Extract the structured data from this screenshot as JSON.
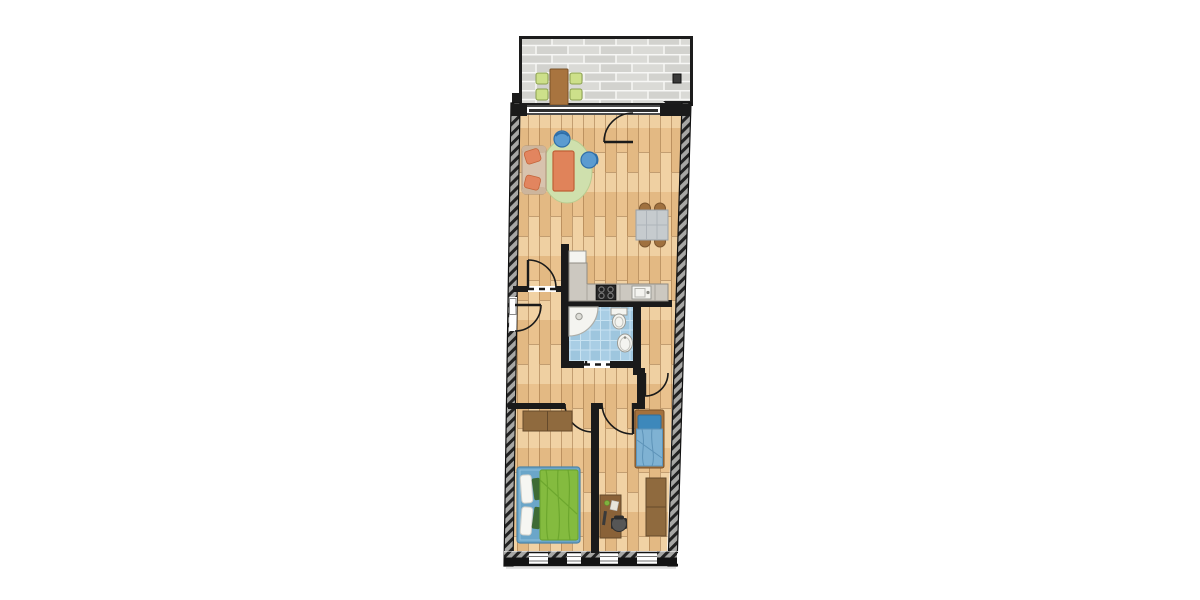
{
  "floor_plan": {
    "type": "apartment-floor-plan",
    "rooms": [
      {
        "name": "balcony",
        "furniture": [
          "outdoor-table",
          "outdoor-chair",
          "outdoor-chair",
          "outdoor-chair",
          "outdoor-chair",
          "wall-lamp"
        ]
      },
      {
        "name": "living-room",
        "furniture": [
          "sofa",
          "round-rug",
          "coffee-table",
          "lounge-chair",
          "lounge-chair",
          "dining-table",
          "dining-chair",
          "dining-chair",
          "dining-chair",
          "dining-chair"
        ]
      },
      {
        "name": "kitchen",
        "furniture": [
          "counter",
          "stove",
          "sink",
          "fridge"
        ]
      },
      {
        "name": "hallway",
        "furniture": []
      },
      {
        "name": "bathroom",
        "furniture": [
          "corner-shower",
          "toilet",
          "washbasin"
        ]
      },
      {
        "name": "storage-closet",
        "furniture": []
      },
      {
        "name": "bedroom-left",
        "furniture": [
          "double-bed",
          "wardrobe"
        ]
      },
      {
        "name": "bedroom-right",
        "furniture": [
          "single-bed",
          "desk",
          "desk-chair",
          "wardrobe"
        ]
      }
    ],
    "colors": {
      "wall_dark": "#1a1a1a",
      "hatch_bg": "#a7a7a5",
      "hatch_stripe": "#222222",
      "wood_base": "#ecc795",
      "wood_a": "#eac28e",
      "wood_b": "#f1d2a4",
      "wood_c": "#e3b983",
      "wood_d": "#efd0a2",
      "brick": "#dadad6",
      "brick_alt": "#d2d2ce",
      "brick_joint": "#f7f7f5",
      "tile": "#a9cee5",
      "tile_alt": "#9ec6de",
      "tile_line": "#c9e3f2",
      "rug": "#cfe0ad",
      "coffee_table": "#e0835a",
      "sofa": "#d8c3ae",
      "sofa_pillow": "#e2855f",
      "chair_blue": "#5b9bd0",
      "chair_blue_dark": "#2f6ea8",
      "dining_table": "#c6cbce",
      "dining_chair": "#a0713f",
      "balcony_table": "#a8743f",
      "balcony_chair": "#cde08a",
      "counter": "#ccc8c0",
      "stove": "#262626",
      "fixture_white": "#f4f4f0",
      "bed_frame_blue": "#6ba6c9",
      "duvet_green": "#84bb3f",
      "duvet_fold": "#68a22b",
      "pillow_white": "#f6f6f2",
      "pillow_green": "#3e6b35",
      "single_duvet": "#7fb2d3",
      "single_pillow": "#3d88bb",
      "wood_furniture": "#8f6a3e",
      "desk_chair": "#565656",
      "window_glass": "#ffffff"
    }
  }
}
